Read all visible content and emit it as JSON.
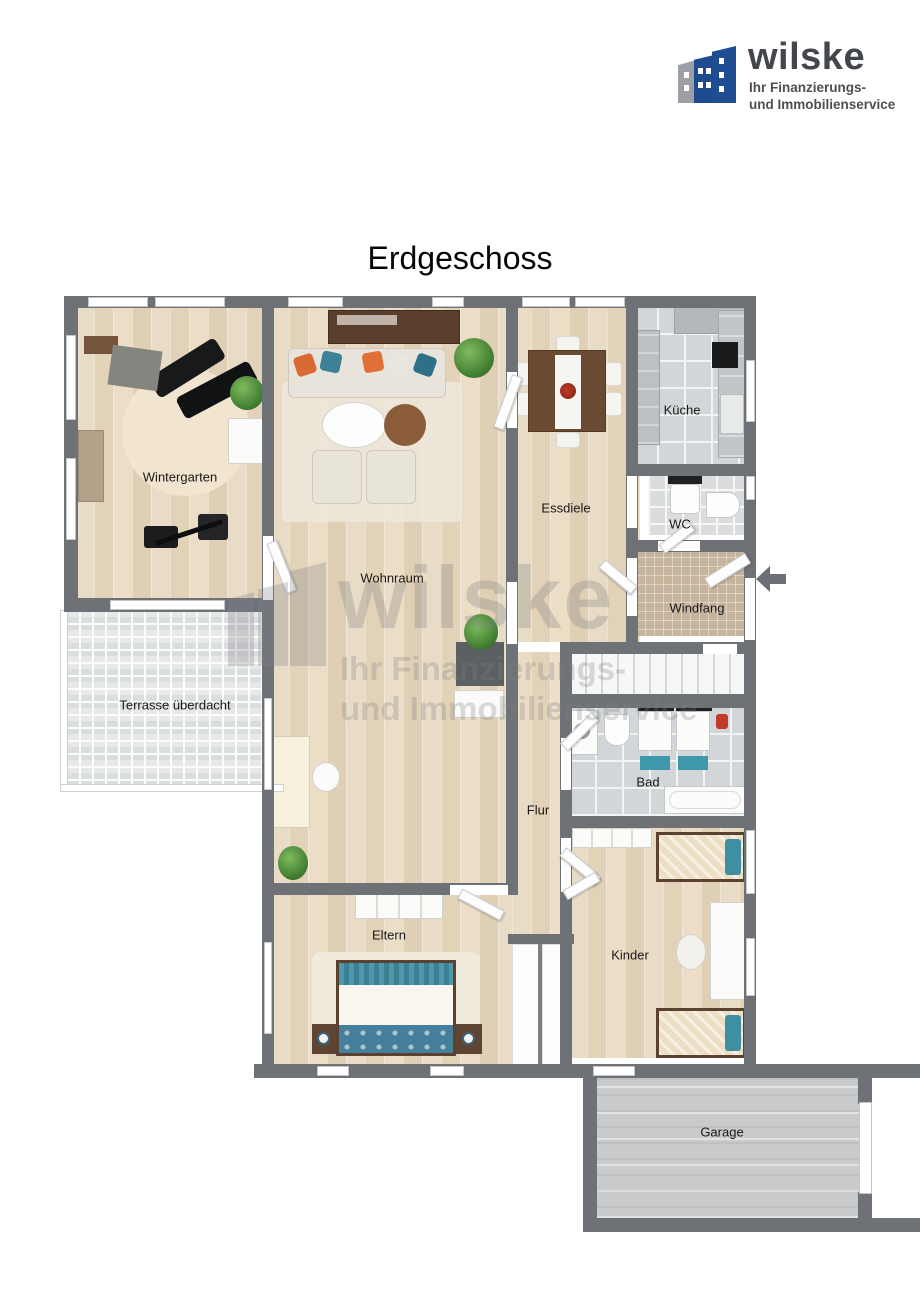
{
  "title": "Erdgeschoss",
  "logo": {
    "brand": "wilske",
    "tagline1": "Ihr Finanzierungs-",
    "tagline2": "und Immobilienservice"
  },
  "watermark": {
    "brand": "wilske",
    "tagline1": "Ihr Finanzierungs-",
    "tagline2": "und Immobilienservice"
  },
  "floorplan": {
    "rooms": [
      {
        "id": "wintergarten",
        "label": "Wintergarten"
      },
      {
        "id": "wohnraum",
        "label": "Wohnraum"
      },
      {
        "id": "essdiele",
        "label": "Essdiele"
      },
      {
        "id": "kueche",
        "label": "Küche"
      },
      {
        "id": "wc",
        "label": "WC"
      },
      {
        "id": "windfang",
        "label": "Windfang"
      },
      {
        "id": "terrasse",
        "label": "Terrasse überdacht"
      },
      {
        "id": "bad",
        "label": "Bad"
      },
      {
        "id": "flur",
        "label": "Flur"
      },
      {
        "id": "eltern",
        "label": "Eltern"
      },
      {
        "id": "kinder",
        "label": "Kinder"
      },
      {
        "id": "garage",
        "label": "Garage"
      }
    ],
    "entrance": {
      "side": "right",
      "indicator": "arrow-pointing-left"
    }
  },
  "colors": {
    "wall": "#6e7277",
    "wood_floor": "#e6d7bf",
    "tile_gray": "#d3d6d8",
    "tile_tan": "#c7b49c",
    "terrace_tile": "#e7e9e9",
    "concrete": "#c8cacb",
    "accent_teal": "#3f8fa3",
    "accent_orange": "#e06a35",
    "logo_blue": "#1d4b8f",
    "logo_gray": "#9b9ea3"
  }
}
